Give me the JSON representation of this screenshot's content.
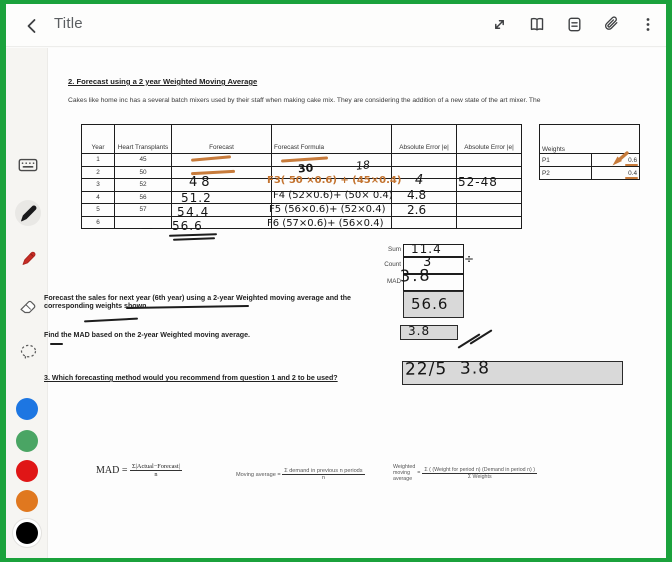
{
  "colors": {
    "accent_green": "#1ba23c",
    "orange_ink": "#c3732f",
    "box_gray": "#d9d9d9",
    "palette": [
      "#1d76e2",
      "#4aa564",
      "#e01616",
      "#e0781f",
      "#000000"
    ]
  },
  "topbar": {
    "title": "Title",
    "icons": [
      "back-icon",
      "expand-icon",
      "reader-view-icon",
      "page-icon",
      "attachment-icon",
      "more-icon"
    ]
  },
  "toolbar": {
    "tools": [
      "keyboard",
      "pen",
      "marker",
      "eraser",
      "lasso"
    ],
    "selected_tool": "pen",
    "selected_color": "black"
  },
  "doc": {
    "heading": "2.  Forecast using a 2 year Weighted Moving Average",
    "intro": "Cakes like home inc has a several batch mixers used by their staff when making cake mix.  They are considering the addition of a new state of the art mixer.  The",
    "table": {
      "headers": [
        "Year",
        "Heart Transplants",
        "Forecast",
        "Forecast Formula",
        "Absolute Error |e|",
        "Absolute Error |e|"
      ],
      "rows": [
        {
          "year": "1",
          "value": "45"
        },
        {
          "year": "2",
          "value": "50"
        },
        {
          "year": "3",
          "value": "52"
        },
        {
          "year": "4",
          "value": "56"
        },
        {
          "year": "5",
          "value": "57"
        },
        {
          "year": "6",
          "value": ""
        }
      ]
    },
    "summary": {
      "sum_label": "Sum",
      "count_label": "Count",
      "mad_label": "MAD"
    },
    "weights": {
      "title": "Weights",
      "rows": [
        {
          "label": "P1",
          "value": "0.6"
        },
        {
          "label": "P2",
          "value": "0.4"
        }
      ]
    },
    "questions": {
      "q1": "Forecast the sales for next year (6th year) using a 2-year Weighted moving average and the corresponding weights shown.",
      "q2": "Find the MAD based on the 2-year Weighted moving average.",
      "q3": "3.  Which forecasting method would you recommend from question 1 and 2 to be used?"
    },
    "formulas": {
      "mad_lhs": "MAD =",
      "mad_num": "Σ|Actual−Forecast|",
      "mad_den": "n",
      "ma_lhs": "Moving average =",
      "ma_num": "Σ demand in previous n periods",
      "ma_den": "n",
      "wma_lhs1": "Weighted",
      "wma_lhs2": "moving",
      "wma_lhs3": "average",
      "wma_eq": "=",
      "wma_num": "Σ ( (Weight for period n) (Demand in period n) )",
      "wma_den": "Σ Weights"
    }
  },
  "handwriting": {
    "row2_a": "30",
    "row2_b": "18",
    "dash6": "—",
    "fc3": "48",
    "fc4": "51.2",
    "fc5": "54.4",
    "fc6": "56.6",
    "f3": "F3( 50 ×0.6) + (45×0.4)",
    "f4": "F4 (52×0.6)+ (50× 0.4)",
    "f5": "F5 (56×0.6)+ (52×0.4)",
    "f6": "F6 (57×0.6)+ (56×0.4)",
    "err3": "4",
    "err4": "4.8",
    "err5": "2.6",
    "err2_3": "52-48",
    "sum": "11.4",
    "count": "3",
    "divide": "÷",
    "mad": "3.8",
    "ans_forecast": "56.6",
    "ans_mad": "3.8",
    "ans_q3": "22/5  3.8"
  }
}
